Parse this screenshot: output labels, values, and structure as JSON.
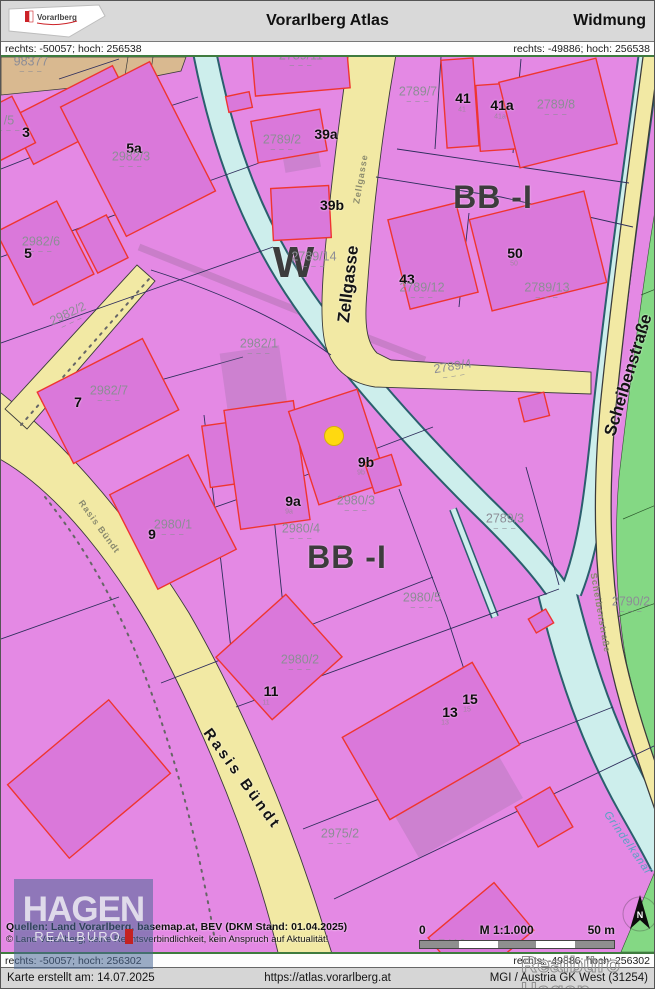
{
  "header": {
    "logo_text": "Vorarlberg",
    "title": "Vorarlberg Atlas",
    "subtitle": "Widmung"
  },
  "coords": {
    "top_left": "rechts: -50057; hoch: 256538",
    "top_right": "rechts: -49886; hoch: 256538",
    "bottom_left": "rechts: -50057; hoch: 256302",
    "bottom_right": "rechts: -49886; hoch: 256302"
  },
  "sources": {
    "line1": "Quellen: Land Vorarlberg, basemap.at, BEV (DKM Stand: 01.04.2025)",
    "line2": "© Land Vorarlberg; keine Rechtsverbindlichkeit, kein Anspruch auf Aktualität!"
  },
  "scalebar": {
    "zero": "0",
    "ratio": "M 1:1.000",
    "max": "50 m"
  },
  "footer": {
    "created": "Karte erstellt am: 14.07.2025",
    "url": "https://atlas.vorarlberg.at",
    "crs": "MGI / Austria GK West (31254)"
  },
  "watermark": {
    "logo_line1": "HAGEN",
    "logo_line2": "REALBÜRO",
    "outline_text": "Realbüro Hagen"
  },
  "north_label": "N",
  "colors": {
    "zone_pink": "#e489e4",
    "building_pink": "#da78da",
    "building_outline_red": "#ef3530",
    "road_yellow": "#f2e9a4",
    "stream_cyan": "#cdeeec",
    "green_zone": "#84d884",
    "tan_zone": "#d9b990",
    "marker_yellow": "#ffd910",
    "coord_bar_green": "#3f7b3f"
  },
  "map": {
    "labels": [
      {
        "t": "W",
        "x": 293,
        "y": 206,
        "cls": "zone zw"
      },
      {
        "t": "BB -I",
        "x": 492,
        "y": 140,
        "cls": "zone"
      },
      {
        "t": "BB -I",
        "x": 346,
        "y": 500,
        "cls": "zone"
      },
      {
        "t": "Zellgasse",
        "x": 347,
        "y": 227,
        "cls": "st",
        "rot": -83
      },
      {
        "t": "Zellgasse",
        "x": 360,
        "y": 122,
        "cls": "ss",
        "rot": -80
      },
      {
        "t": "Scheibenstraße",
        "x": 627,
        "y": 318,
        "cls": "st",
        "rot": -73
      },
      {
        "t": "Scheibenstraße",
        "x": 599,
        "y": 556,
        "cls": "ss",
        "rot": 80
      },
      {
        "t": "Rasis Bündt",
        "x": 241,
        "y": 722,
        "cls": "st ls2",
        "rot": 54
      },
      {
        "t": "Rasis Bündt",
        "x": 98,
        "y": 470,
        "cls": "ss",
        "rot": 54
      },
      {
        "t": "Grindelkanal",
        "x": 626,
        "y": 786,
        "cls": "kn",
        "rot": 55
      },
      {
        "t": "3",
        "x": 25,
        "y": 75,
        "cls": "hn"
      },
      {
        "t": "5a",
        "x": 133,
        "y": 91,
        "cls": "hn"
      },
      {
        "t": "5",
        "x": 27,
        "y": 196,
        "cls": "hn"
      },
      {
        "t": "7",
        "x": 77,
        "y": 345,
        "cls": "hn"
      },
      {
        "t": "9",
        "x": 151,
        "y": 477,
        "cls": "hn"
      },
      {
        "t": "9a",
        "x": 292,
        "y": 444,
        "cls": "hn"
      },
      {
        "t": "9b",
        "x": 365,
        "y": 405,
        "cls": "hn"
      },
      {
        "t": "11",
        "x": 270,
        "y": 634,
        "cls": "hn"
      },
      {
        "t": "13",
        "x": 449,
        "y": 655,
        "cls": "hn"
      },
      {
        "t": "15",
        "x": 469,
        "y": 642,
        "cls": "hn"
      },
      {
        "t": "39a",
        "x": 325,
        "y": 77,
        "cls": "hn"
      },
      {
        "t": "39b",
        "x": 331,
        "y": 148,
        "cls": "hn"
      },
      {
        "t": "41",
        "x": 462,
        "y": 41,
        "cls": "hn"
      },
      {
        "t": "41a",
        "x": 501,
        "y": 48,
        "cls": "hn"
      },
      {
        "t": "43",
        "x": 406,
        "y": 222,
        "cls": "hn"
      },
      {
        "t": "50",
        "x": 514,
        "y": 196,
        "cls": "hn"
      },
      {
        "t": "41",
        "x": 461,
        "y": 53,
        "cls": "hs"
      },
      {
        "t": "41a",
        "x": 499,
        "y": 60,
        "cls": "hs"
      },
      {
        "t": "50",
        "x": 513,
        "y": 207,
        "cls": "hs"
      },
      {
        "t": "13",
        "x": 444,
        "y": 666,
        "cls": "hs"
      },
      {
        "t": "15",
        "x": 466,
        "y": 653,
        "cls": "hs"
      },
      {
        "t": "11",
        "x": 265,
        "y": 646,
        "cls": "hs"
      },
      {
        "t": "9a",
        "x": 288,
        "y": 455,
        "cls": "hs"
      },
      {
        "t": "9b",
        "x": 360,
        "y": 416,
        "cls": "hs"
      },
      {
        "t": "98377",
        "x": 30,
        "y": 7,
        "cls": "pn"
      },
      {
        "t": "/5",
        "x": 8,
        "y": 66,
        "cls": "pn"
      },
      {
        "t": "2982/3",
        "x": 130,
        "y": 102,
        "cls": "pn"
      },
      {
        "t": "2982/6",
        "x": 40,
        "y": 187,
        "cls": "pn"
      },
      {
        "t": "2982/2",
        "x": 68,
        "y": 259,
        "cls": "pn",
        "rot": -25
      },
      {
        "t": "2982/1",
        "x": 258,
        "y": 289,
        "cls": "pn"
      },
      {
        "t": "2982/7",
        "x": 108,
        "y": 336,
        "cls": "pn"
      },
      {
        "t": "2789/11",
        "x": 300,
        "y": 1,
        "cls": "pn"
      },
      {
        "t": "2789/2",
        "x": 281,
        "y": 85,
        "cls": "pn"
      },
      {
        "t": "2789/7",
        "x": 417,
        "y": 37,
        "cls": "pn"
      },
      {
        "t": "2789/8",
        "x": 555,
        "y": 50,
        "cls": "pn"
      },
      {
        "t": "2789/12",
        "x": 421,
        "y": 233,
        "cls": "pn"
      },
      {
        "t": "2789/13",
        "x": 546,
        "y": 233,
        "cls": "pn"
      },
      {
        "t": "2789/14",
        "x": 313,
        "y": 202,
        "cls": "pn"
      },
      {
        "t": "2789/4",
        "x": 452,
        "y": 312,
        "cls": "pn",
        "rot": -9
      },
      {
        "t": "2789/3",
        "x": 504,
        "y": 464,
        "cls": "pn"
      },
      {
        "t": "2790/2",
        "x": 630,
        "y": 547,
        "cls": "pn"
      },
      {
        "t": "2980/1",
        "x": 172,
        "y": 470,
        "cls": "pn"
      },
      {
        "t": "2980/3",
        "x": 355,
        "y": 446,
        "cls": "pn"
      },
      {
        "t": "2980/4",
        "x": 300,
        "y": 474,
        "cls": "pn"
      },
      {
        "t": "2980/5",
        "x": 421,
        "y": 543,
        "cls": "pn"
      },
      {
        "t": "2980/2",
        "x": 299,
        "y": 605,
        "cls": "pn"
      },
      {
        "t": "2975/2",
        "x": 339,
        "y": 779,
        "cls": "pn"
      },
      {
        "t": "7412",
        "x": 451,
        "y": 890,
        "cls": "pn"
      }
    ]
  }
}
